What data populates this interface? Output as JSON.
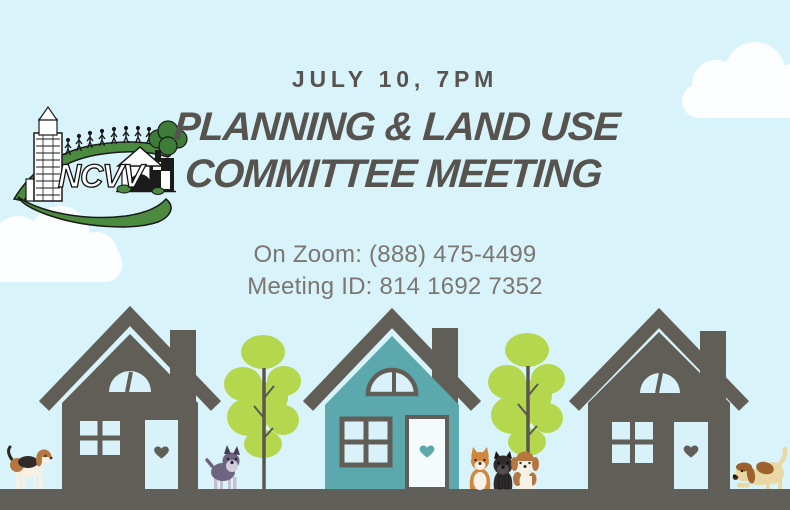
{
  "flyer": {
    "date_time": "JULY 10, 7PM",
    "title_line1": "PLANNING & LAND USE",
    "title_line2": "COMMITTEE MEETING",
    "zoom_info": "On Zoom: (888) 475-4499",
    "meeting_id": "Meeting ID: 814 1692 7352"
  },
  "logo": {
    "org_acronym": "NCVV"
  },
  "palette": {
    "sky": "#d8f4fa",
    "cloud": "#fcfeff",
    "heading_text": "#57534f",
    "body_text": "#7b7672",
    "house_gray": "#615e58",
    "house_teal": "#5ba8ad",
    "ground": "#615f5a",
    "tree_green": "#b5d74e",
    "trunk": "#5a5750",
    "window_pane": "#d9f2f9",
    "door_light": "#f4fbfd",
    "logo_green": "#4c8b3f",
    "logo_ink": "#1a1a1a",
    "beagle_white": "#f6f1e4",
    "beagle_brown": "#b5763f",
    "beagle_dark": "#2f2b28",
    "schnauzer_body": "#6f6480",
    "schnauzer_face": "#d3cdd9",
    "shiba_orange": "#d0883f",
    "shiba_cream": "#f6f2e8",
    "pug_black": "#302c2d",
    "pug_muzzle": "#554e4e",
    "hound_cream": "#e9d8a3",
    "hound_brown": "#9c612c",
    "hound_dark": "#4a2d17"
  },
  "scene": {
    "clouds": [
      "cloud-bottom-left",
      "cloud-top-right"
    ],
    "houses": [
      "gray-house-left",
      "teal-house-center",
      "gray-house-right"
    ],
    "trees": [
      "oak-tree-left",
      "oak-tree-right"
    ],
    "dogs": [
      "beagle-standing",
      "schnauzer-puppy",
      "shiba-puppy",
      "black-pug-puppy",
      "beagle-puppy",
      "hound-playing"
    ]
  }
}
